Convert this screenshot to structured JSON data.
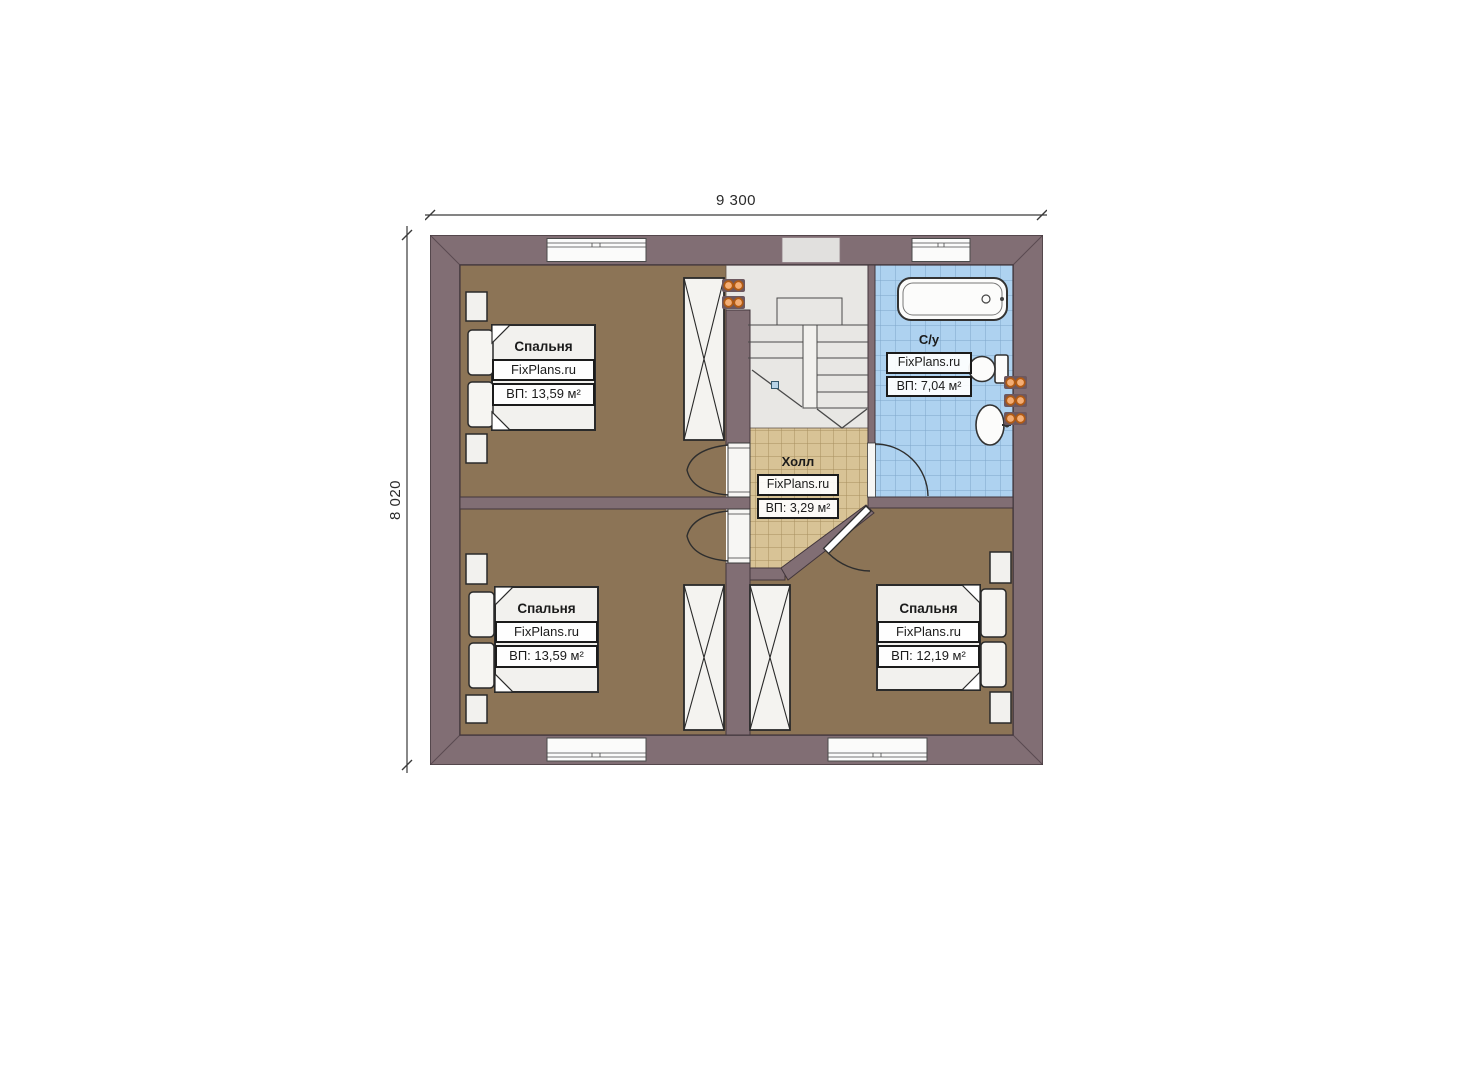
{
  "plan": {
    "title": "second-floor-plan",
    "dimensions": {
      "width_label": "9 300",
      "height_label": "8 020"
    },
    "rooms": {
      "bedroom_top_left": {
        "name": "Спальня",
        "brand": "FixPlans.ru",
        "area": "ВП: 13,59 м²"
      },
      "bedroom_bottom_left": {
        "name": "Спальня",
        "brand": "FixPlans.ru",
        "area": "ВП: 13,59 м²"
      },
      "bedroom_bottom_right": {
        "name": "Спальня",
        "brand": "FixPlans.ru",
        "area": "ВП: 12,19 м²"
      },
      "bathroom": {
        "name": "С/у",
        "brand": "FixPlans.ru",
        "area": "ВП: 7,04 м²"
      },
      "hall": {
        "name": "Холл",
        "brand": "FixPlans.ru",
        "area": "ВП: 3,29 м²"
      }
    },
    "colors": {
      "wall": "#816e74",
      "wood_floor": "#8c7456",
      "bath_tile": "#aed2f0",
      "hall_tile": "#d8c396",
      "stair_floor": "#e8e7e4",
      "radiator_accent": "#ef9a4d"
    }
  }
}
